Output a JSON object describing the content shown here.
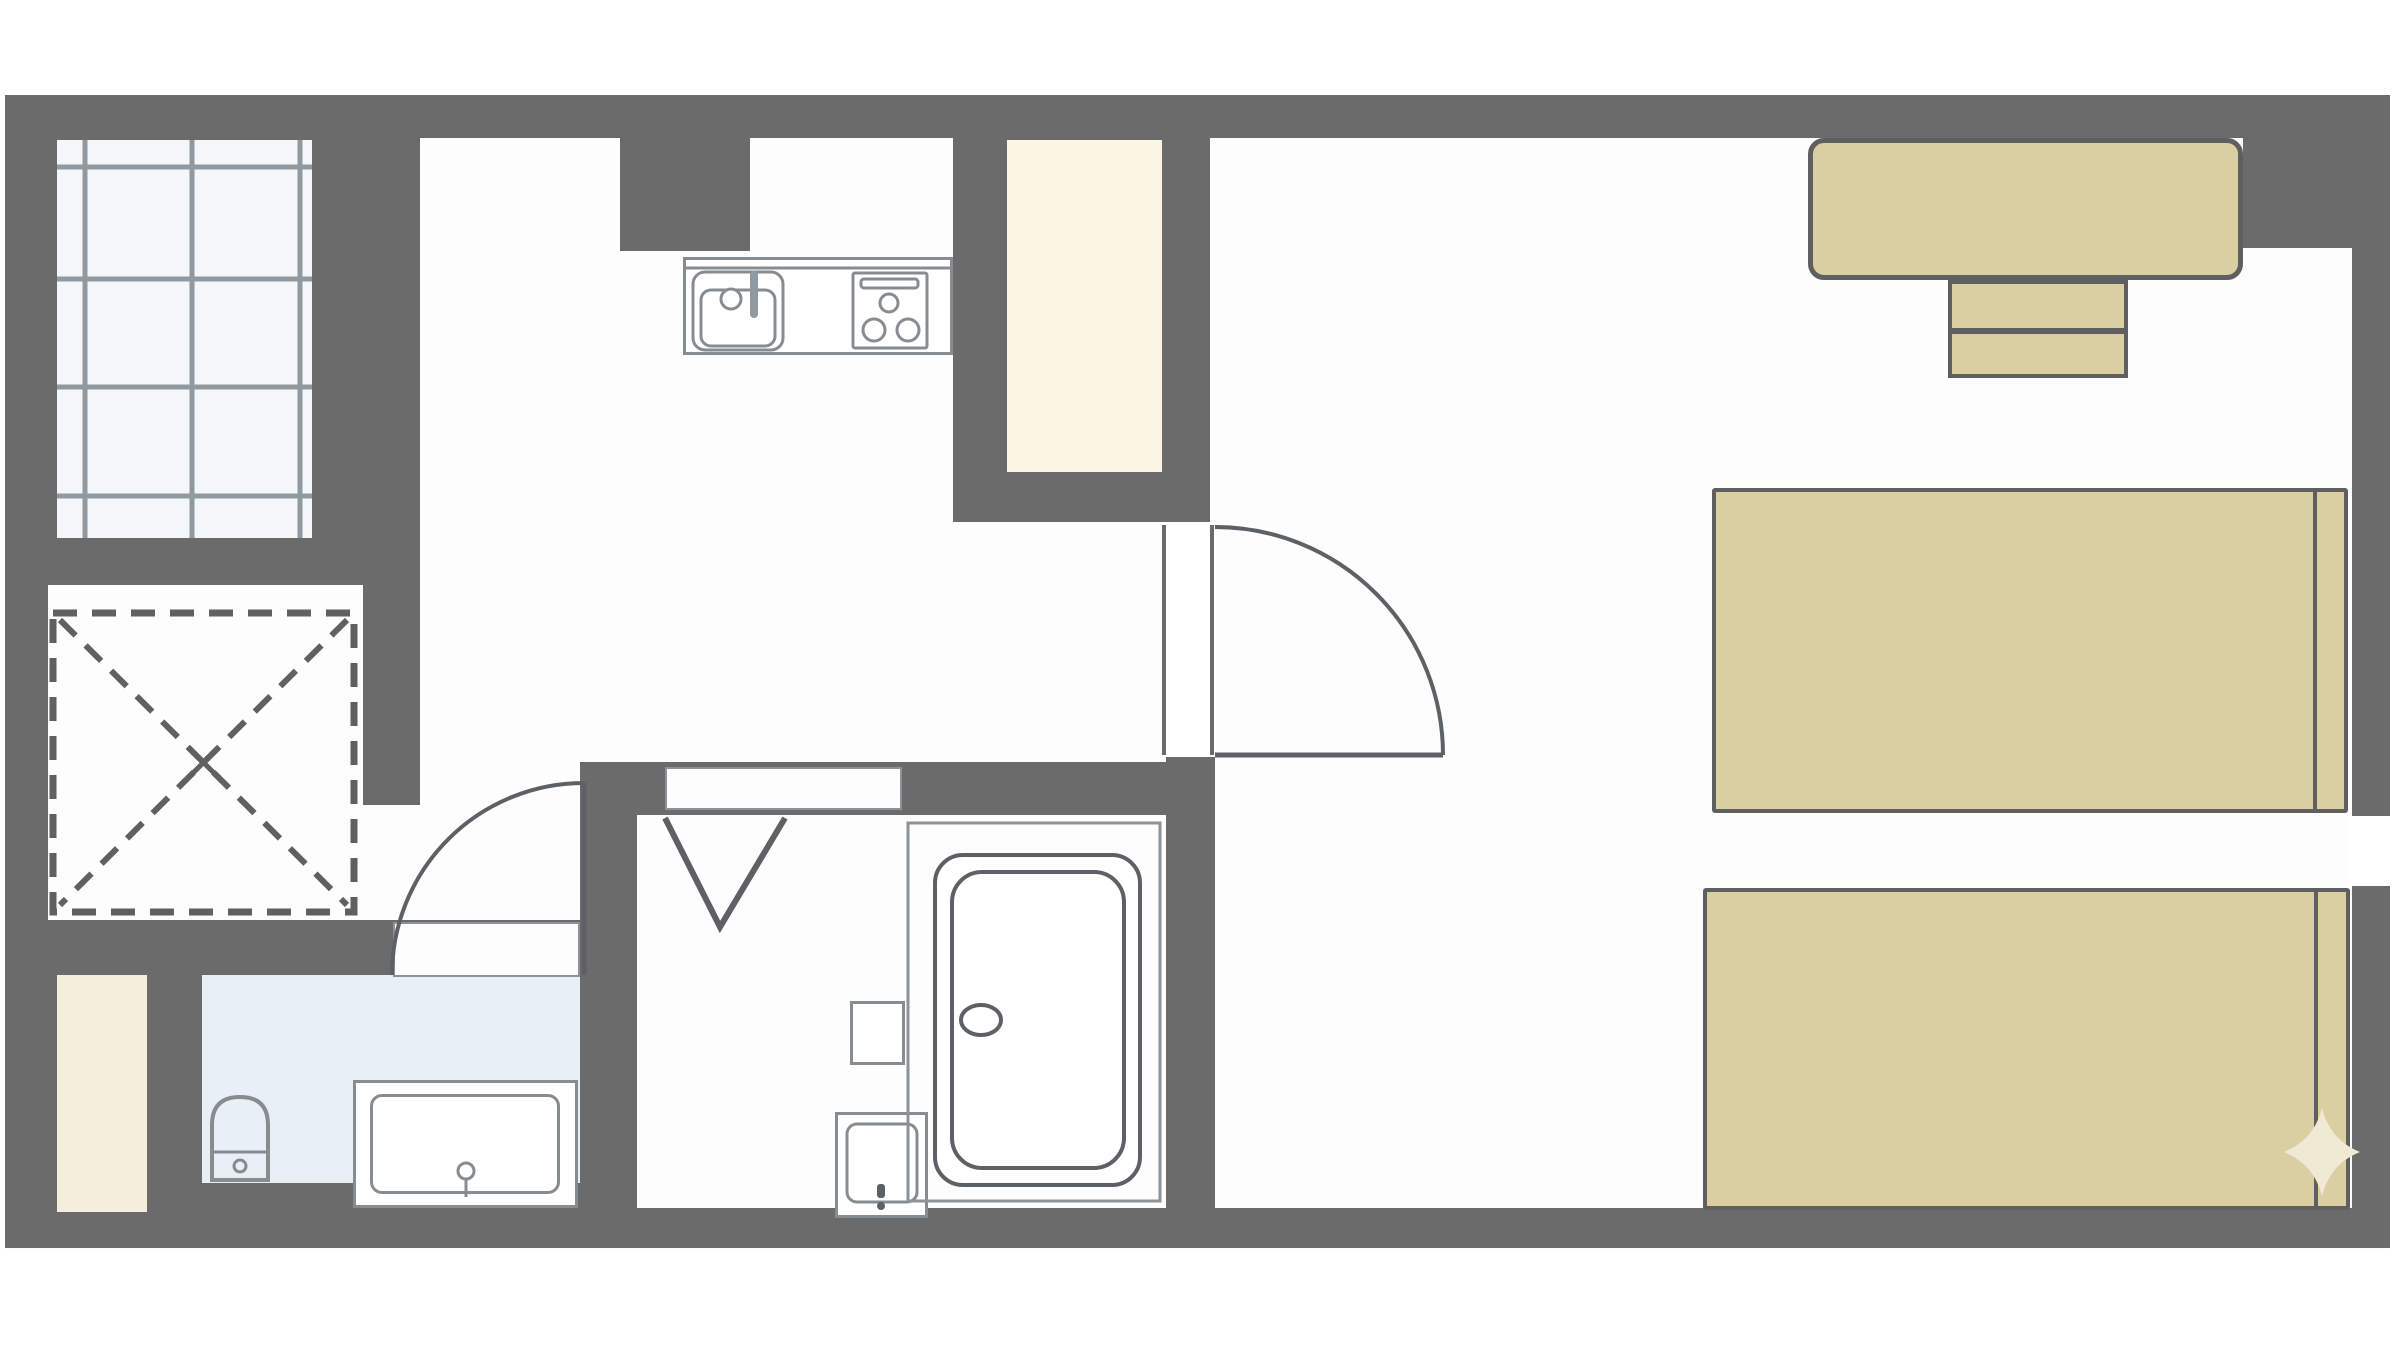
{
  "page": {
    "kind": "floor-plan-diagram",
    "text_content": "none"
  },
  "palette": {
    "wall": "#6b6b6b",
    "floor": "#fdfdfd",
    "white": "#ffffff",
    "pane": "#f4f6f8",
    "grid": "#9099a0",
    "cream": "#fcf5e3",
    "cream2": "#f6eedd",
    "blue": "#e8f0f6",
    "tan": "#d9cfa3",
    "furnline": "#5f5f5f",
    "fixline": "#878c91",
    "thinline": "#8d9296",
    "darkline": "#5d6165",
    "dash": "#606060",
    "sparkle": "#f0e9d3"
  },
  "floorplan": {
    "canvas": {
      "w": 2400,
      "h": 1350
    },
    "rects": [
      {
        "n": "floor-area",
        "c": "floor",
        "x": 5,
        "y": 95,
        "w": 2385,
        "h": 1155
      },
      {
        "n": "wall-left",
        "c": "wall",
        "x": 5,
        "y": 95,
        "w": 43,
        "h": 1153
      },
      {
        "n": "wall-top",
        "c": "wall",
        "x": 5,
        "y": 95,
        "w": 2382,
        "h": 43
      },
      {
        "n": "wall-right",
        "c": "wall",
        "x": 2352,
        "y": 95,
        "w": 38,
        "h": 1153
      },
      {
        "n": "wall-bottom",
        "c": "wall",
        "x": 5,
        "y": 1208,
        "w": 2385,
        "h": 40
      },
      {
        "n": "wall-window-surround",
        "c": "wall",
        "x": 5,
        "y": 95,
        "w": 415,
        "h": 490
      },
      {
        "n": "wall-window-stub",
        "c": "wall",
        "x": 363,
        "y": 585,
        "w": 57,
        "h": 220
      },
      {
        "n": "wall-kitchen-block",
        "c": "wall",
        "x": 620,
        "y": 95,
        "w": 130,
        "h": 156
      },
      {
        "n": "wall-closet-block",
        "c": "wall",
        "x": 953,
        "y": 95,
        "w": 257,
        "h": 427
      },
      {
        "n": "wall-east",
        "c": "wall",
        "x": 1166,
        "y": 757,
        "w": 49,
        "h": 451
      },
      {
        "n": "wall-washbath-north",
        "c": "wall",
        "x": 580,
        "y": 762,
        "w": 586,
        "h": 53
      },
      {
        "n": "wall-washroom-west",
        "c": "wall",
        "x": 580,
        "y": 815,
        "w": 57,
        "h": 393
      },
      {
        "n": "wall-toilet-north",
        "c": "wall",
        "x": 45,
        "y": 920,
        "w": 535,
        "h": 59
      },
      {
        "n": "wall-entrance-block",
        "c": "wall",
        "x": 45,
        "y": 920,
        "w": 157,
        "h": 328
      },
      {
        "n": "wall-corner-topright",
        "c": "wall",
        "x": 2243,
        "y": 95,
        "w": 144,
        "h": 153
      },
      {
        "n": "wall-bottomleft-extra",
        "c": "wall",
        "x": 45,
        "y": 1183,
        "w": 592,
        "h": 25
      },
      {
        "n": "window-pane",
        "c": "pane",
        "x": 57,
        "y": 140,
        "w": 255,
        "h": 398
      },
      {
        "n": "closet-interior",
        "c": "cream",
        "x": 1007,
        "y": 140,
        "w": 155,
        "h": 332
      },
      {
        "n": "entrance-mat",
        "c": "cream2",
        "x": 57,
        "y": 975,
        "w": 90,
        "h": 237
      },
      {
        "n": "toilet-room",
        "c": "blue",
        "x": 202,
        "y": 975,
        "w": 378,
        "h": 208
      },
      {
        "n": "bedroom-door-opening",
        "c": "white",
        "x": 1162,
        "y": 522,
        "w": 53,
        "h": 235
      },
      {
        "n": "toilet-door-opening",
        "c": "opening",
        "x": 393,
        "y": 922,
        "w": 187,
        "h": 55
      },
      {
        "n": "washroom-sliding-door",
        "c": "opening",
        "x": 665,
        "y": 767,
        "w": 237,
        "h": 43
      },
      {
        "n": "beds-gap-white",
        "c": "white",
        "x": 2348,
        "y": 816,
        "w": 42,
        "h": 70
      },
      {
        "n": "kitchen-counter",
        "c": "fixture",
        "x": 683,
        "y": 257,
        "w": 270,
        "h": 98
      },
      {
        "n": "desk",
        "c": "furn",
        "x": 1808,
        "y": 138,
        "w": 435,
        "h": 142,
        "r": 16,
        "bw": 5
      },
      {
        "n": "chair-upper",
        "c": "furn",
        "x": 1948,
        "y": 280,
        "w": 180,
        "h": 52
      },
      {
        "n": "chair-lower",
        "c": "furn",
        "x": 1948,
        "y": 330,
        "w": 180,
        "h": 48
      },
      {
        "n": "bed-1",
        "c": "furn",
        "x": 1712,
        "y": 488,
        "w": 636,
        "h": 325,
        "r": 3
      },
      {
        "n": "bed-2",
        "c": "furn",
        "x": 1703,
        "y": 888,
        "w": 647,
        "h": 322,
        "r": 3
      },
      {
        "n": "vanity",
        "c": "fixture",
        "x": 353,
        "y": 1080,
        "w": 225,
        "h": 128
      },
      {
        "n": "vanity-inner",
        "c": "fixture",
        "x": 370,
        "y": 1094,
        "w": 190,
        "h": 100,
        "r": 12
      },
      {
        "n": "bath-wall-box",
        "c": "fixture",
        "x": 850,
        "y": 1001,
        "w": 55,
        "h": 64
      },
      {
        "n": "washbasin",
        "c": "fixture",
        "x": 835,
        "y": 1112,
        "w": 93,
        "h": 106
      }
    ]
  }
}
